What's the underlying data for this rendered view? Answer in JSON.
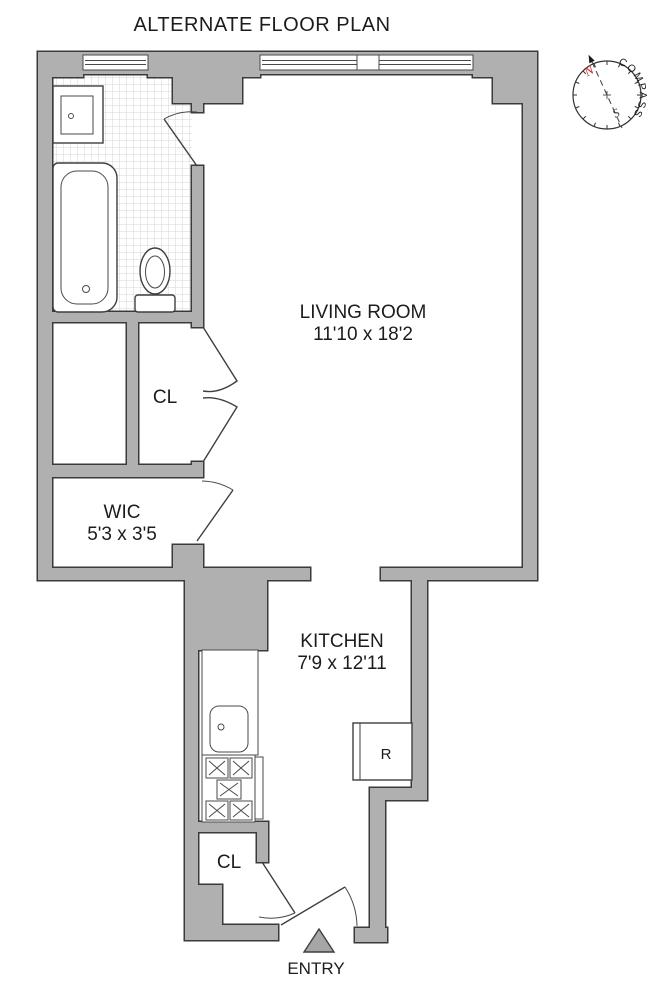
{
  "title": "ALTERNATE FLOOR PLAN",
  "rooms": {
    "living_room": {
      "name": "LIVING ROOM",
      "dims": "11'10 x 18'2"
    },
    "kitchen": {
      "name": "KITCHEN",
      "dims": "7'9 x 12'11"
    },
    "wic": {
      "name": "WIC",
      "dims": "5'3 x 3'5"
    },
    "closet_hall": {
      "name": "CL"
    },
    "closet_kitchen": {
      "name": "CL"
    }
  },
  "labels": {
    "refrigerator": "R",
    "entry": "ENTRY"
  },
  "compass": {
    "label": "COMPASS",
    "north": "N",
    "south": "S"
  },
  "colors": {
    "wall_fill": "#b0b0b0",
    "outline": "#3a3a3a",
    "north_arrow": "#cc2222",
    "tile_line": "#d4d4d4"
  }
}
